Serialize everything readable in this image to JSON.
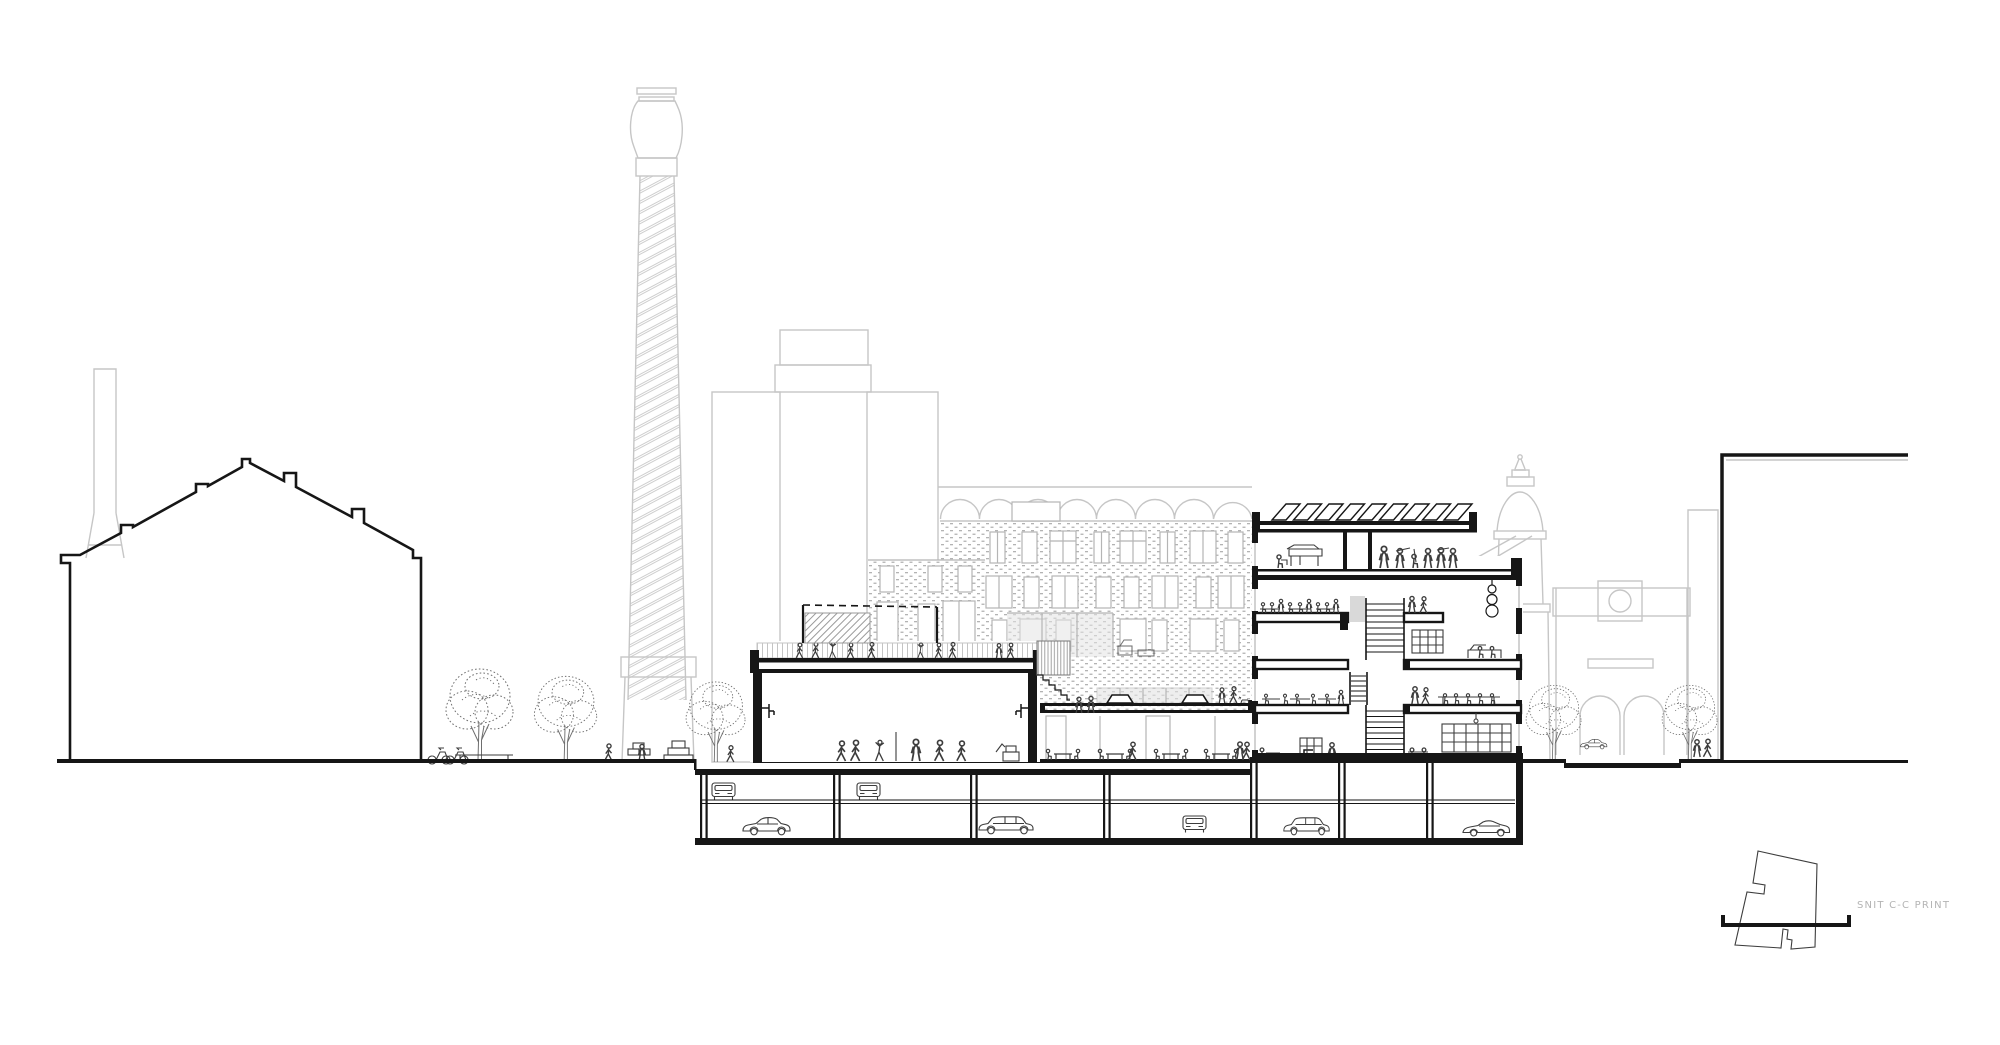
{
  "key_plan": {
    "label": "SNIT C-C PRINT"
  },
  "colors": {
    "line_black": "#161616",
    "sketch_dark": "#3d3d3d",
    "background_gray": "#c6c6c6",
    "window_gray": "#b5b5b5",
    "brick_dot_gray": "#b3b3b3",
    "glass_gray": "#e3e3e3",
    "label_gray": "#b4b4b4",
    "paper_white": "#ffffff"
  },
  "scene": {
    "garage": {
      "column_bays": 7,
      "cars_front_view": 3,
      "cars_side_view": 4
    },
    "roof_solar_panels": 9,
    "pendant_lamp_globes": 3,
    "basketball_hoops": 2,
    "street_arches": 2,
    "trees_left": 3,
    "trees_right": 2
  }
}
